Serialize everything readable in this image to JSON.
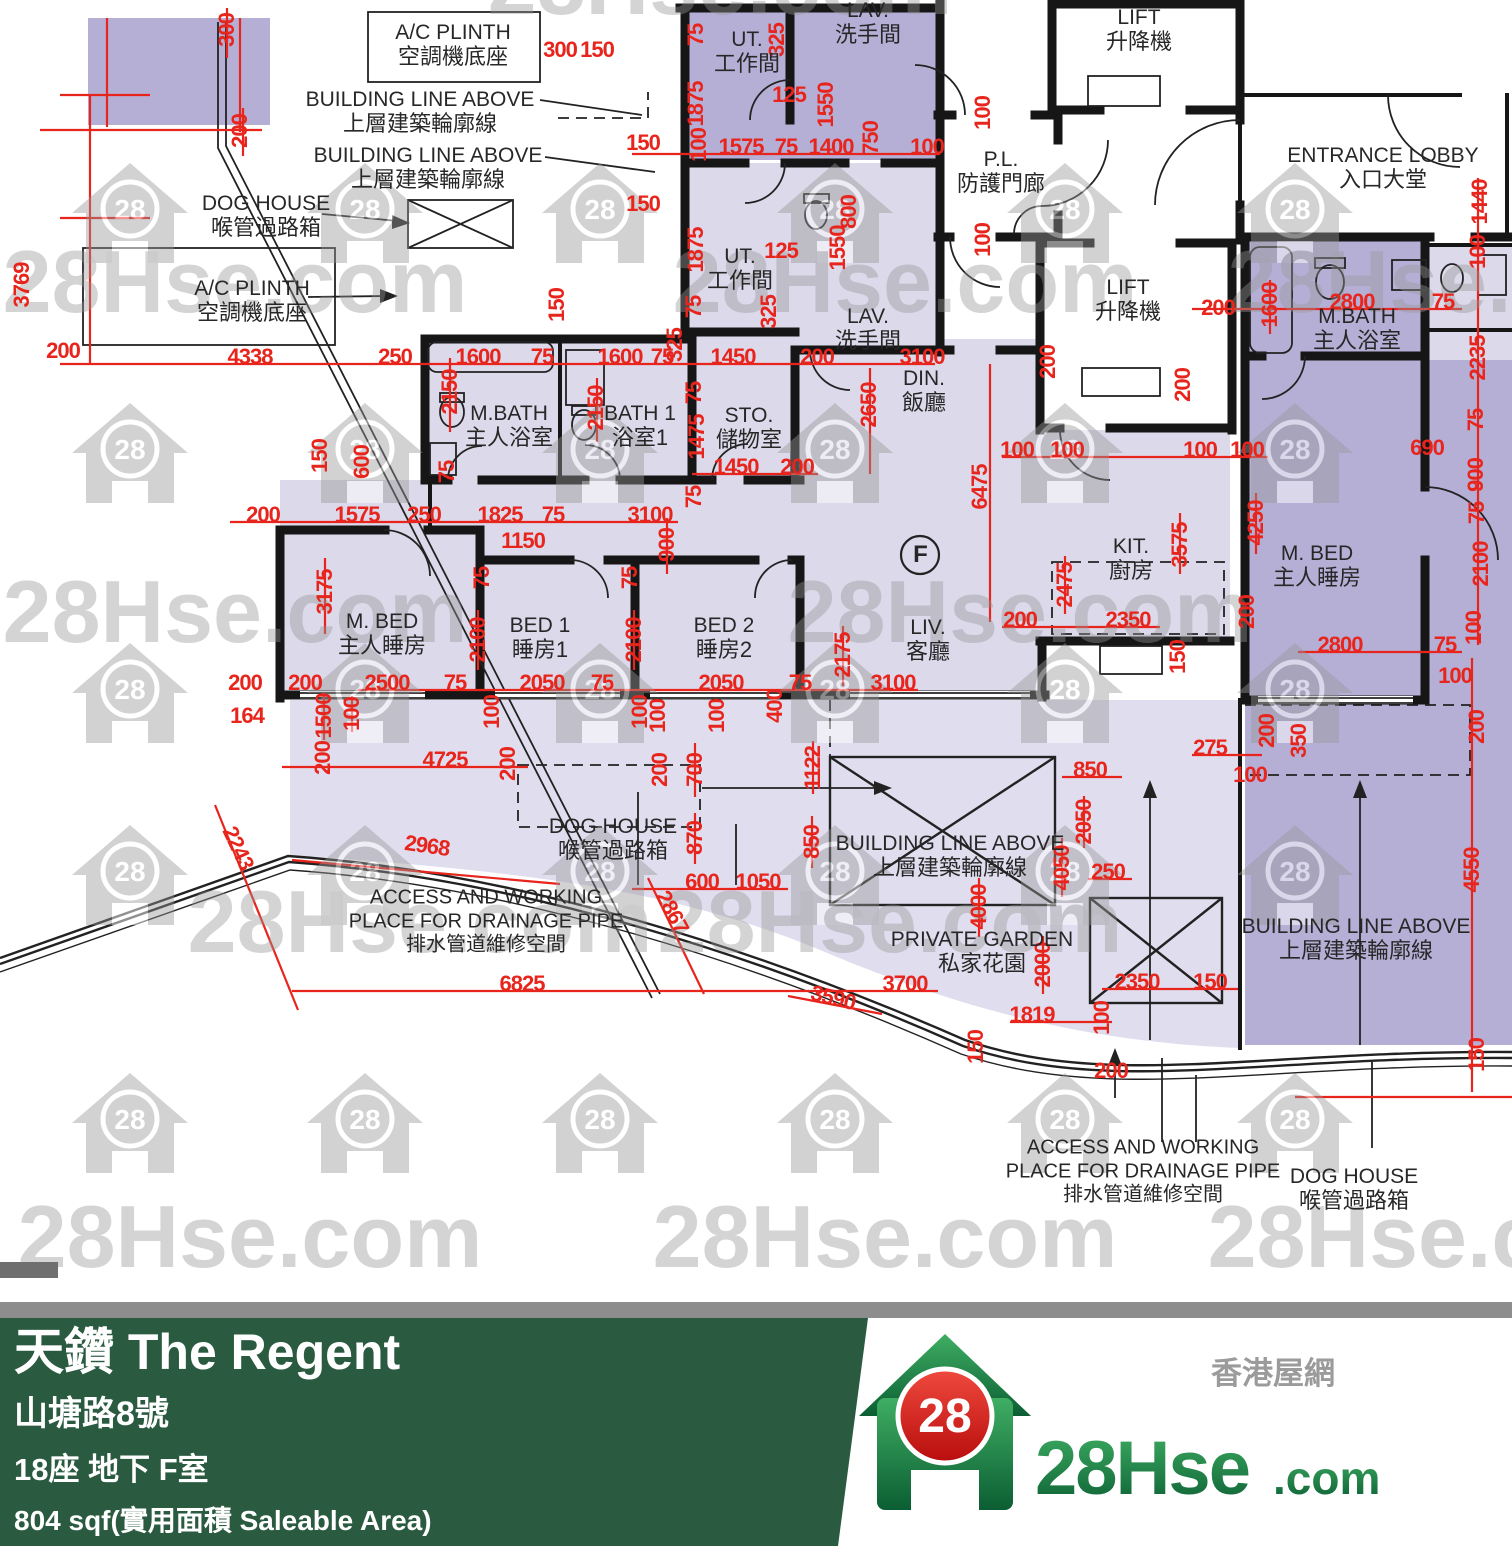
{
  "colors": {
    "dim_red": "#e8251d",
    "wall": "#161616",
    "fill_light": "#dcd9ea",
    "fill_dark": "#b5afd6",
    "fill_garden": "#e0deee",
    "banner_green": "#2a5b41",
    "watermark_gray": "#969696",
    "logo_green_light": "#3fae63",
    "logo_green_dark": "#0b5e33",
    "logo_red": "#d81414"
  },
  "plan": {
    "unit_circle_label": "F",
    "room_labels": [
      {
        "en": "A/C PLINTH",
        "zh": "空調機底座",
        "x": 453,
        "y": 45
      },
      {
        "en": "BUILDING LINE ABOVE",
        "zh": "上層建築輪廓線",
        "x": 420,
        "y": 112
      },
      {
        "en": "BUILDING LINE ABOVE",
        "zh": "上層建築輪廓線",
        "x": 428,
        "y": 168
      },
      {
        "en": "DOG HOUSE",
        "zh": "喉管過路箱",
        "x": 266,
        "y": 216
      },
      {
        "en": "A/C PLINTH",
        "zh": "空調機底座",
        "x": 252,
        "y": 301
      },
      {
        "en": "UT.",
        "zh": "工作間",
        "x": 747,
        "y": 52
      },
      {
        "en": "LAV.",
        "zh": "洗手間",
        "x": 868,
        "y": 23
      },
      {
        "en": "P.L.",
        "zh": "防護門廊",
        "x": 1001,
        "y": 172
      },
      {
        "en": "LIFT",
        "zh": "升降機",
        "x": 1139,
        "y": 30
      },
      {
        "en": "ENTRANCE LOBBY",
        "zh": "入口大堂",
        "x": 1383,
        "y": 168
      },
      {
        "en": "UT.",
        "zh": "工作間",
        "x": 740,
        "y": 269
      },
      {
        "en": "LAV.",
        "zh": "洗手間",
        "x": 868,
        "y": 329
      },
      {
        "en": "LIFT",
        "zh": "升降機",
        "x": 1128,
        "y": 300
      },
      {
        "en": "M.BATH",
        "zh": "主人浴室",
        "x": 1357,
        "y": 329
      },
      {
        "en": "M.BATH",
        "zh": "主人浴室",
        "x": 509,
        "y": 426
      },
      {
        "en": "BATH 1",
        "zh": "浴室1",
        "x": 640,
        "y": 426
      },
      {
        "en": "STO.",
        "zh": "儲物室",
        "x": 749,
        "y": 428
      },
      {
        "en": "DIN.",
        "zh": "飯廳",
        "x": 924,
        "y": 391
      },
      {
        "en": "KIT.",
        "zh": "廚房",
        "x": 1131,
        "y": 559
      },
      {
        "en": "M. BED",
        "zh": "主人睡房",
        "x": 1317,
        "y": 566
      },
      {
        "en": "M. BED",
        "zh": "主人睡房",
        "x": 382,
        "y": 634
      },
      {
        "en": "BED 1",
        "zh": "睡房1",
        "x": 540,
        "y": 638
      },
      {
        "en": "BED 2",
        "zh": "睡房2",
        "x": 724,
        "y": 638
      },
      {
        "en": "LIV.",
        "zh": "客廳",
        "x": 928,
        "y": 640
      },
      {
        "en": "DOG HOUSE",
        "zh": "喉管過路箱",
        "x": 613,
        "y": 839
      },
      {
        "en": "BUILDING LINE ABOVE",
        "zh": "上層建築輪廓線",
        "x": 950,
        "y": 856
      },
      {
        "en": "PRIVATE GARDEN",
        "zh": "私家花園",
        "x": 982,
        "y": 952
      },
      {
        "en": "BUILDING LINE ABOVE",
        "zh": "上層建築輪廓線",
        "x": 1356,
        "y": 939
      },
      {
        "en": "DOG HOUSE",
        "zh": "喉管過路箱",
        "x": 1354,
        "y": 1189
      }
    ],
    "notes": [
      {
        "lines": [
          "ACCESS AND WORKING",
          "PLACE FOR DRAINAGE PIPE",
          "排水管道維修空間"
        ],
        "x": 486,
        "y": 922
      },
      {
        "lines": [
          "ACCESS AND WORKING",
          "PLACE FOR DRAINAGE PIPE",
          "排水管道維修空間"
        ],
        "x": 1143,
        "y": 1172
      }
    ],
    "dims": [
      [
        "300",
        227,
        30,
        -90
      ],
      [
        "200",
        240,
        131,
        -90
      ],
      [
        "3769",
        22,
        285,
        -90
      ],
      [
        "200",
        63,
        351,
        0
      ],
      [
        "4338",
        250,
        357,
        0
      ],
      [
        "250",
        395,
        357,
        0
      ],
      [
        "300",
        560,
        50,
        0
      ],
      [
        "150",
        597,
        50,
        0
      ],
      [
        "150",
        643,
        143,
        0
      ],
      [
        "150",
        643,
        204,
        0
      ],
      [
        "75",
        696,
        35,
        -90
      ],
      [
        "325",
        777,
        40,
        -90
      ],
      [
        "1875",
        696,
        104,
        -90
      ],
      [
        "125",
        789,
        95,
        0
      ],
      [
        "1550",
        826,
        105,
        -90
      ],
      [
        "100",
        699,
        145,
        -90
      ],
      [
        "1575",
        741,
        147,
        0
      ],
      [
        "75",
        786,
        147,
        0
      ],
      [
        "1400",
        831,
        147,
        0
      ],
      [
        "750",
        871,
        138,
        -90
      ],
      [
        "100",
        927,
        147,
        0
      ],
      [
        "100",
        983,
        113,
        -90
      ],
      [
        "800",
        849,
        212,
        -90
      ],
      [
        "1550",
        838,
        248,
        -90
      ],
      [
        "125",
        781,
        251,
        0
      ],
      [
        "1875",
        696,
        250,
        -90
      ],
      [
        "75",
        694,
        307,
        -90
      ],
      [
        "150",
        557,
        305,
        -90
      ],
      [
        "325",
        769,
        312,
        -90
      ],
      [
        "100",
        983,
        240,
        -90
      ],
      [
        "1600",
        478,
        357,
        0
      ],
      [
        "75",
        542,
        357,
        0
      ],
      [
        "1600",
        620,
        357,
        0
      ],
      [
        "75",
        662,
        357,
        0
      ],
      [
        "325",
        675,
        345,
        -90
      ],
      [
        "1450",
        733,
        357,
        0
      ],
      [
        "200",
        817,
        357,
        0
      ],
      [
        "3100",
        922,
        357,
        0
      ],
      [
        "200",
        1218,
        308,
        0
      ],
      [
        "1600",
        1270,
        305,
        -90
      ],
      [
        "2800",
        1352,
        302,
        0
      ],
      [
        "75",
        1443,
        302,
        0
      ],
      [
        "1440",
        1480,
        202,
        -90
      ],
      [
        "100",
        1478,
        252,
        -90
      ],
      [
        "2235",
        1478,
        358,
        -90
      ],
      [
        "75",
        1476,
        420,
        -90
      ],
      [
        "690",
        1427,
        448,
        0
      ],
      [
        "900",
        1476,
        475,
        -90
      ],
      [
        "75",
        1477,
        513,
        -90
      ],
      [
        "2100",
        1481,
        564,
        -90
      ],
      [
        "100",
        1474,
        628,
        -90
      ],
      [
        "2800",
        1340,
        645,
        0
      ],
      [
        "75",
        1445,
        645,
        0
      ],
      [
        "2150",
        450,
        392,
        -90
      ],
      [
        "2150",
        596,
        408,
        -90
      ],
      [
        "150",
        320,
        456,
        -90
      ],
      [
        "600",
        362,
        462,
        -90
      ],
      [
        "75",
        447,
        472,
        -90
      ],
      [
        "75",
        694,
        393,
        -90
      ],
      [
        "1475",
        697,
        437,
        -90
      ],
      [
        "75",
        694,
        497,
        -90
      ],
      [
        "1450",
        736,
        467,
        0
      ],
      [
        "200",
        797,
        467,
        0
      ],
      [
        "2650",
        869,
        405,
        -90
      ],
      [
        "6475",
        980,
        487,
        -90
      ],
      [
        "200",
        263,
        515,
        0
      ],
      [
        "1575",
        357,
        515,
        0
      ],
      [
        "250",
        424,
        515,
        0
      ],
      [
        "1825",
        500,
        515,
        0
      ],
      [
        "75",
        553,
        515,
        0
      ],
      [
        "3100",
        650,
        515,
        0
      ],
      [
        "1150",
        523,
        541,
        0
      ],
      [
        "900",
        667,
        545,
        -90
      ],
      [
        "75",
        482,
        578,
        -90
      ],
      [
        "75",
        630,
        578,
        -90
      ],
      [
        "3175",
        325,
        592,
        -90
      ],
      [
        "200",
        1048,
        362,
        -90
      ],
      [
        "100",
        1017,
        450,
        0
      ],
      [
        "100",
        1067,
        450,
        0
      ],
      [
        "100",
        1200,
        450,
        0
      ],
      [
        "100",
        1247,
        450,
        0
      ],
      [
        "200",
        1183,
        385,
        -90
      ],
      [
        "3575",
        1180,
        545,
        -90
      ],
      [
        "4250",
        1256,
        523,
        -90
      ],
      [
        "2475",
        1065,
        585,
        -90
      ],
      [
        "2350",
        1128,
        620,
        0
      ],
      [
        "200",
        1020,
        620,
        0
      ],
      [
        "200",
        1247,
        612,
        -90
      ],
      [
        "150",
        1178,
        657,
        -90
      ],
      [
        "2100",
        478,
        640,
        -90
      ],
      [
        "2100",
        634,
        640,
        -90
      ],
      [
        "2175",
        843,
        655,
        -90
      ],
      [
        "2500",
        387,
        683,
        0
      ],
      [
        "75",
        455,
        683,
        0
      ],
      [
        "2050",
        542,
        683,
        0
      ],
      [
        "75",
        602,
        683,
        0
      ],
      [
        "2050",
        721,
        683,
        0
      ],
      [
        "75",
        800,
        683,
        0
      ],
      [
        "3100",
        893,
        683,
        0
      ],
      [
        "200",
        245,
        683,
        0
      ],
      [
        "200",
        305,
        683,
        0
      ],
      [
        "164",
        247,
        716,
        0
      ],
      [
        "1500",
        324,
        716,
        -90
      ],
      [
        "100",
        352,
        714,
        -90
      ],
      [
        "100",
        492,
        712,
        -90
      ],
      [
        "100",
        640,
        712,
        -90
      ],
      [
        "200",
        323,
        758,
        -90
      ],
      [
        "400",
        775,
        706,
        -90
      ],
      [
        "100",
        658,
        716,
        -90
      ],
      [
        "100",
        717,
        716,
        -90
      ],
      [
        "1122",
        813,
        768,
        -90
      ],
      [
        "200",
        660,
        770,
        -90
      ],
      [
        "700",
        695,
        770,
        -90
      ],
      [
        "870",
        695,
        838,
        -90
      ],
      [
        "850",
        812,
        842,
        -90
      ],
      [
        "600",
        702,
        882,
        0
      ],
      [
        "1050",
        758,
        882,
        0
      ],
      [
        "4725",
        445,
        760,
        0
      ],
      [
        "200",
        508,
        764,
        -90
      ],
      [
        "2243",
        238,
        848,
        65
      ],
      [
        "2968",
        427,
        846,
        8
      ],
      [
        "2867",
        672,
        912,
        62
      ],
      [
        "3590",
        833,
        998,
        14
      ],
      [
        "6825",
        522,
        984,
        0
      ],
      [
        "3700",
        905,
        984,
        0
      ],
      [
        "275",
        1210,
        748,
        0
      ],
      [
        "100",
        1250,
        775,
        0
      ],
      [
        "200",
        1267,
        731,
        -90
      ],
      [
        "350",
        1299,
        741,
        -90
      ],
      [
        "100",
        1455,
        676,
        0
      ],
      [
        "200",
        1477,
        727,
        -90
      ],
      [
        "850",
        1090,
        770,
        0
      ],
      [
        "2050",
        1084,
        822,
        -90
      ],
      [
        "4050",
        1062,
        868,
        -90
      ],
      [
        "250",
        1108,
        872,
        0
      ],
      [
        "4000",
        979,
        907,
        -90
      ],
      [
        "2000",
        1043,
        965,
        -90
      ],
      [
        "2350",
        1137,
        982,
        0
      ],
      [
        "150",
        1210,
        982,
        0
      ],
      [
        "1819",
        1032,
        1015,
        0
      ],
      [
        "100",
        1102,
        1018,
        -90
      ],
      [
        "150",
        976,
        1047,
        -90
      ],
      [
        "200",
        1111,
        1071,
        0
      ],
      [
        "4550",
        1472,
        870,
        -90
      ],
      [
        "150",
        1477,
        1055,
        -90
      ]
    ]
  },
  "watermark": {
    "text": "28Hse.com",
    "badge": "28"
  },
  "footer": {
    "estate": "天鑽 The Regent",
    "address": "山塘路8號",
    "unit": "18座 地下 F室",
    "area": "804 sqf(實用面積 Saleable Area)"
  },
  "logo": {
    "site_main": "28Hse",
    "site_suffix": ".com",
    "tagline": "香港屋網",
    "badge": "28"
  }
}
